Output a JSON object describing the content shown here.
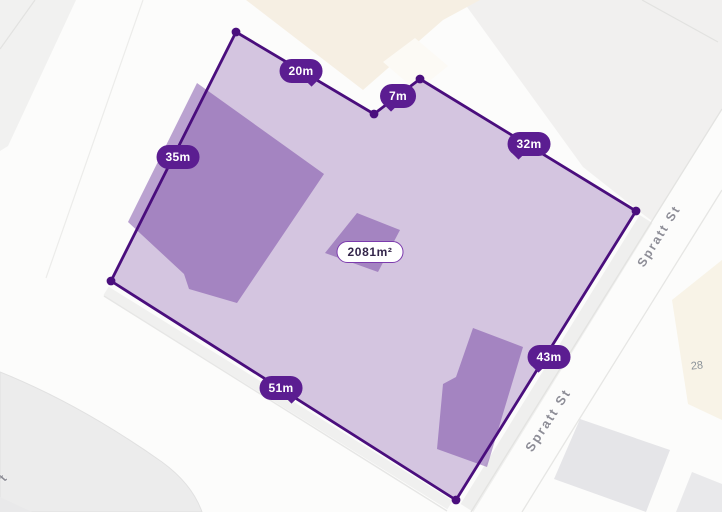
{
  "map": {
    "parcel": {
      "area_label": "2081m²",
      "measurements": [
        {
          "side": "north-west",
          "label": "20m"
        },
        {
          "side": "north-notch",
          "label": "7m"
        },
        {
          "side": "north-east",
          "label": "32m"
        },
        {
          "side": "west",
          "label": "35m"
        },
        {
          "side": "south-east",
          "label": "43m"
        },
        {
          "side": "south",
          "label": "51m"
        }
      ]
    },
    "streets": {
      "primary": "Spratt St",
      "labels": [
        {
          "text": "Spratt St"
        },
        {
          "text": "Spratt St"
        }
      ],
      "edge_fragment": "t"
    },
    "house_numbers": [
      {
        "value": "28"
      }
    ],
    "colors": {
      "boundary": "#4a0e7d",
      "parcel_fill": "rgba(107,53,156,0.28)",
      "building_fill": "rgba(107,53,156,0.45)",
      "measure_pill_bg": "#5b1d91",
      "measure_pill_text": "#ffffff",
      "area_pill_bg": "#ffffff",
      "area_pill_border": "#7c3bad",
      "area_pill_text": "#33254a",
      "street_label_text": "#8e8e97",
      "road": "#ffffff",
      "neighbor_parcel": "#f1f0ef",
      "neighbor_building_beige": "#f6efe3",
      "neighbor_building_gray": "#e5e5e8"
    }
  }
}
